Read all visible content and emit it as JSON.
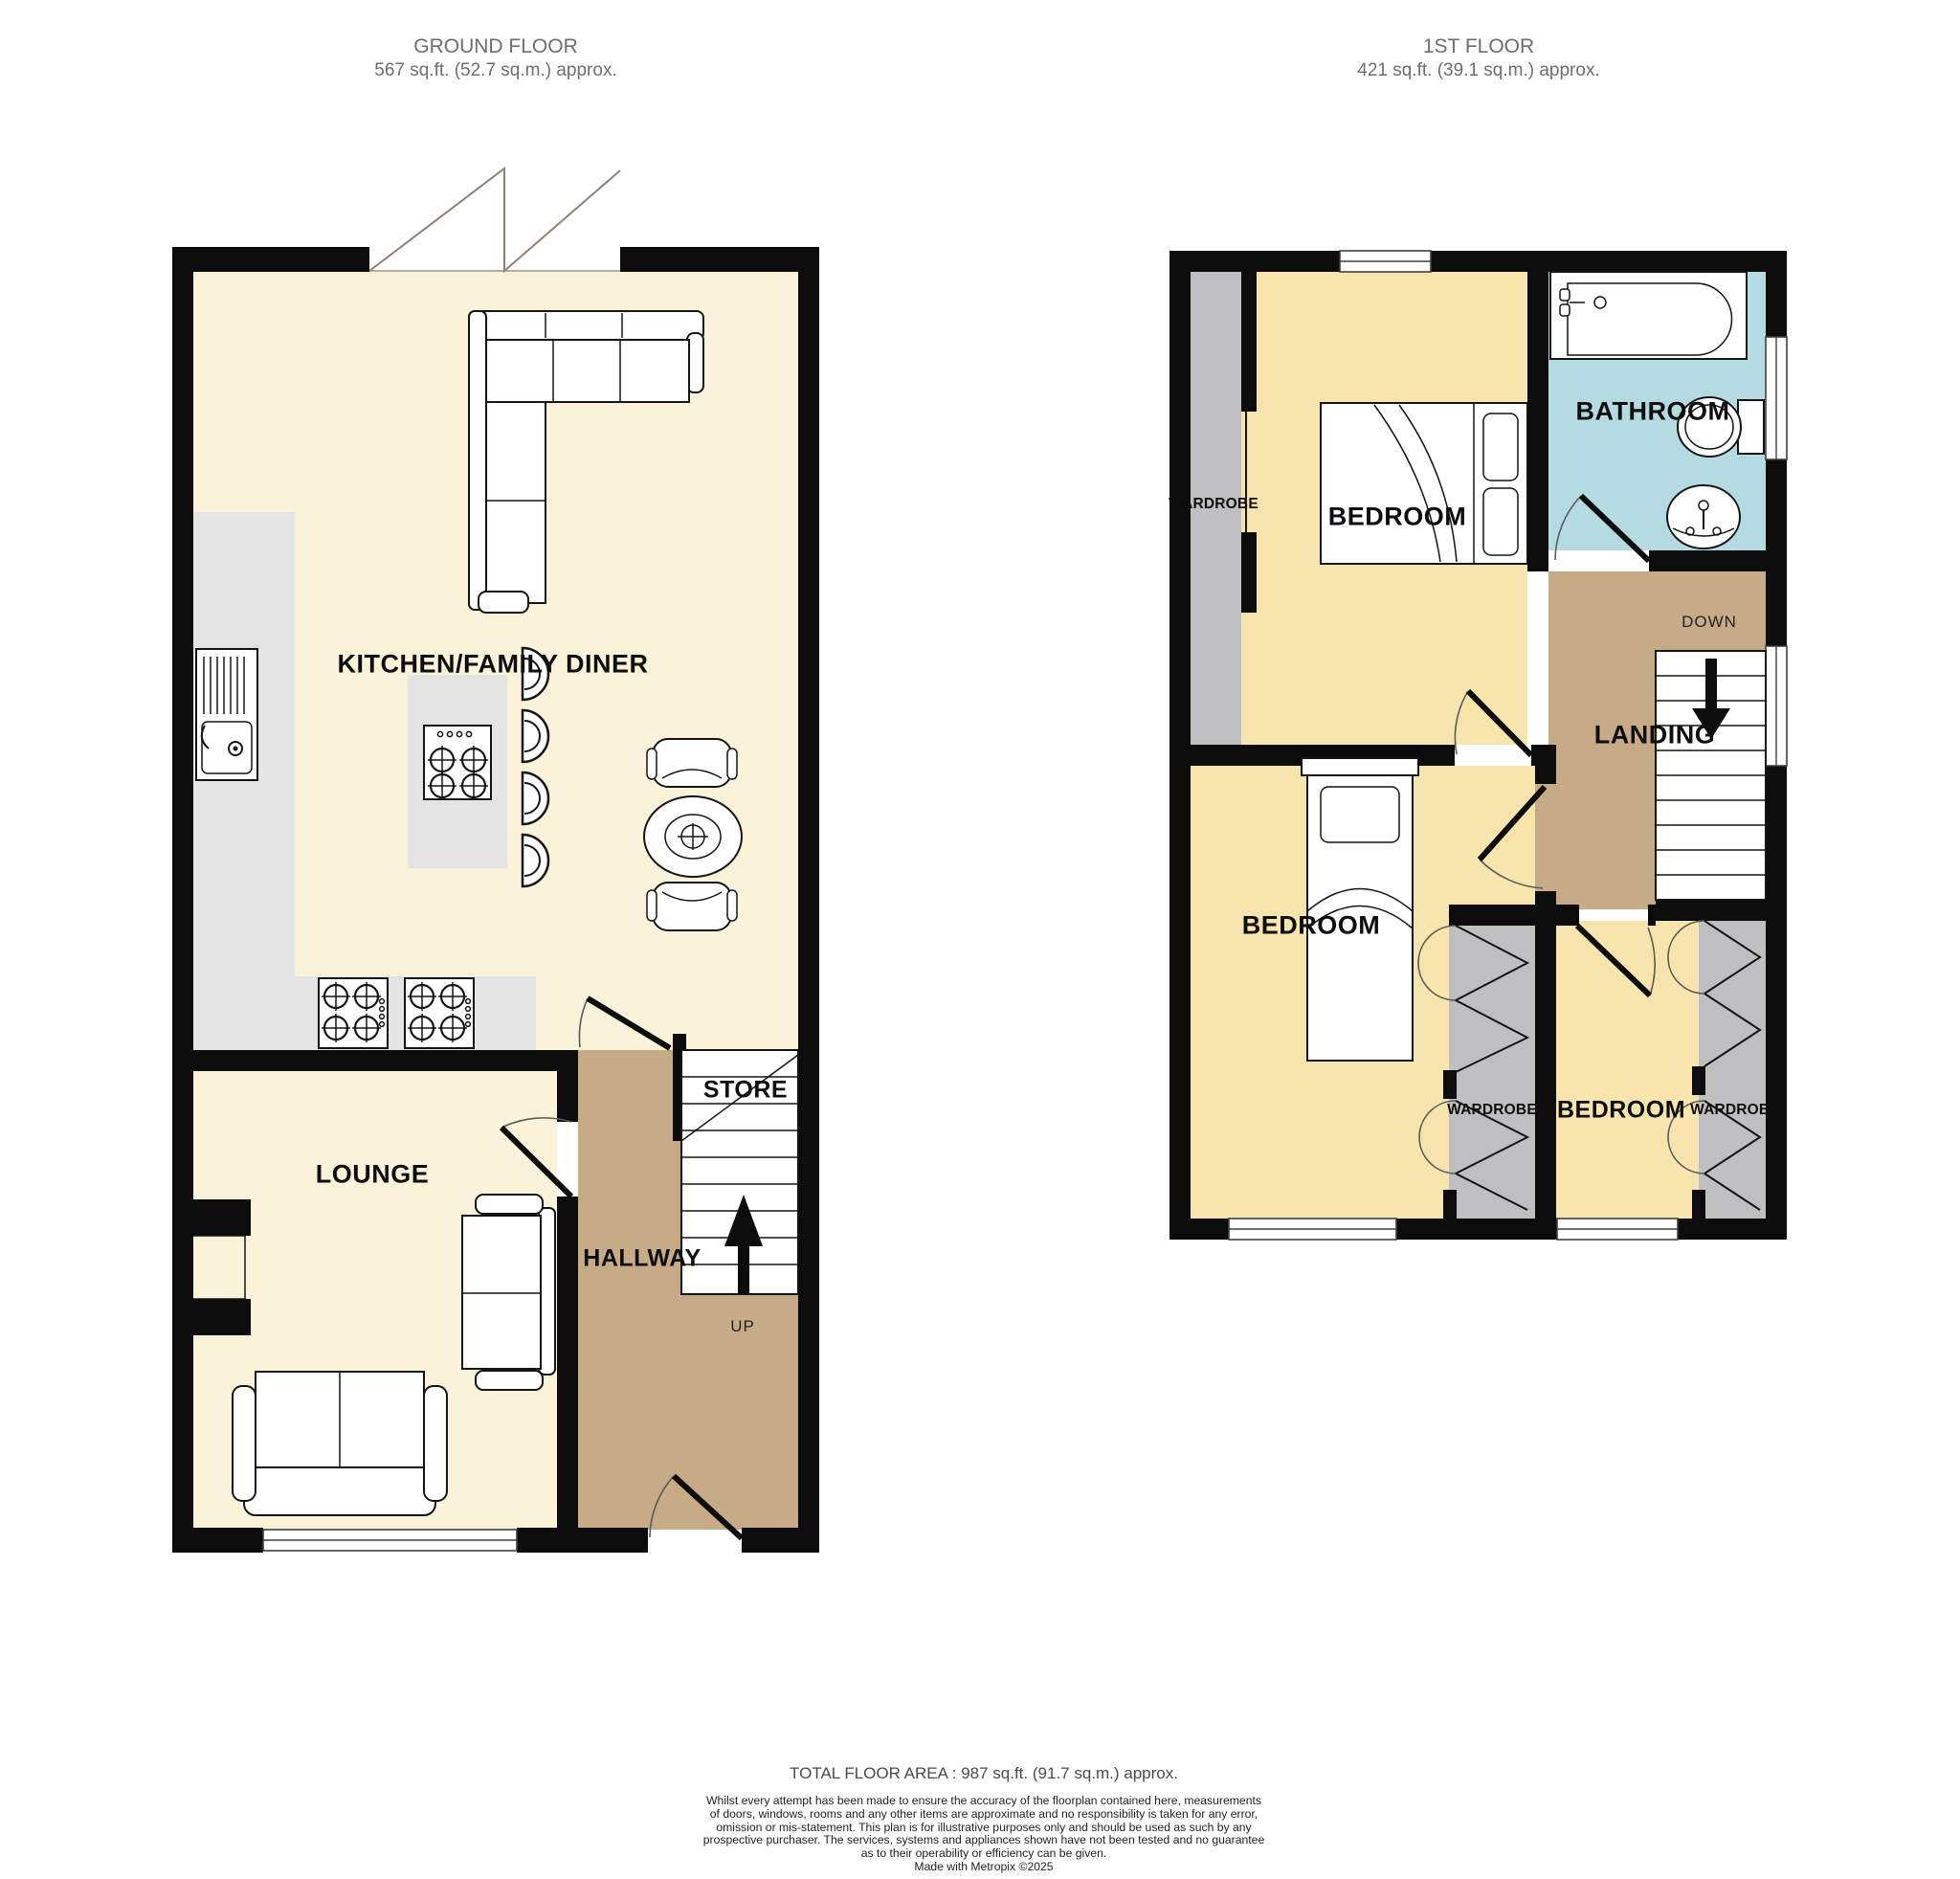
{
  "ground_floor": {
    "title": "GROUND FLOOR",
    "area": "567 sq.ft. (52.7 sq.m.) approx.",
    "labels": {
      "kitchen": "KITCHEN/FAMILY DINER",
      "lounge": "LOUNGE",
      "store": "STORE",
      "hallway": "HALLWAY",
      "up": "UP"
    }
  },
  "first_floor": {
    "title": "1ST FLOOR",
    "area": "421 sq.ft. (39.1 sq.m.) approx.",
    "labels": {
      "bedroom_top": "BEDROOM",
      "bathroom": "BATHROOM",
      "down": "DOWN",
      "landing": "LANDING",
      "bedroom_left": "BEDROOM",
      "bedroom_right": "BEDROOM",
      "wardrobe_top": "WARDROBE",
      "wardrobe_left": "WARDROBE",
      "wardrobe_right": "WARDROBE"
    }
  },
  "footer": {
    "total": "TOTAL FLOOR AREA : 987 sq.ft. (91.7 sq.m.) approx.",
    "disclaimer_lines": [
      "Whilst every attempt has been made to ensure the accuracy of the floorplan contained here, measurements",
      "of doors, windows, rooms and any other items are approximate and no responsibility is taken for any error,",
      "omission or mis-statement. This plan is for illustrative purposes only and should be used as such by any",
      "prospective purchaser. The services, systems and appliances shown have not been tested and no guarantee",
      "as to their operability or efficiency can be given.",
      "Made with Metropix ©2025"
    ]
  },
  "colors": {
    "floor_cream": "#faf3da",
    "floor_bedroom": "#f8e5ad",
    "floor_hall": "#c7ab87",
    "floor_bathroom": "#b5dbe2",
    "counter_gray": "#e4e4e4",
    "wardrobe_gray": "#bfbfc1",
    "wall_black": "#0c0c0c",
    "header_gray": "#6e6e6e"
  }
}
